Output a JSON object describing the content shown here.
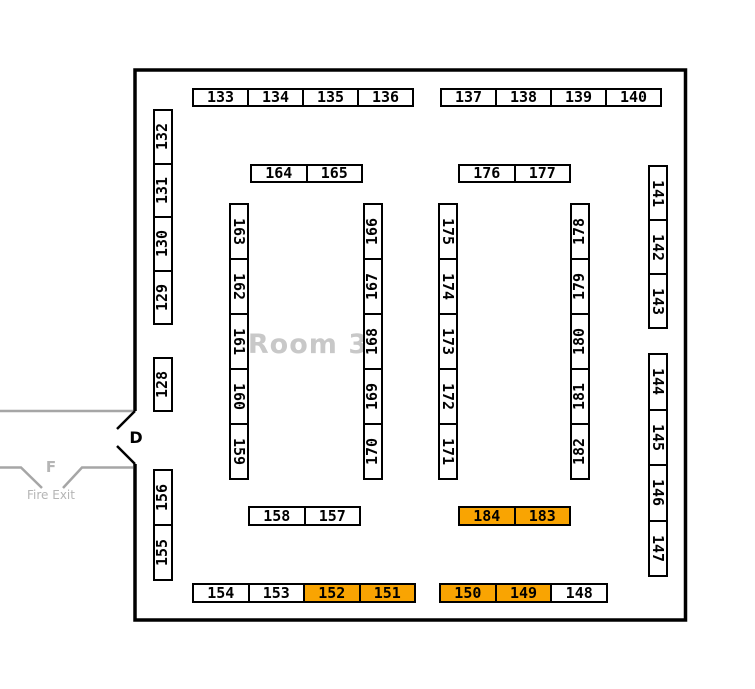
{
  "room": {
    "label": "Room 3"
  },
  "door": {
    "label": "D"
  },
  "fire_exit": {
    "label": "F",
    "text": "Fire Exit"
  },
  "colors": {
    "highlight": "#f9a402",
    "wall": "#000000",
    "corridor_gray": "#a6a6a6",
    "room_label_gray": "#c8c8c8",
    "gray_text": "#b5b5b5",
    "booth_fill": "#ffffff",
    "booth_border": "#000000"
  },
  "highlighted_booths": [
    "184",
    "183",
    "152",
    "151",
    "150",
    "149"
  ],
  "strips": [
    {
      "name": "top-row-west",
      "x": 192,
      "y": 88,
      "dir": "h",
      "cell_w": 57,
      "cell_h": 19,
      "orient": "h",
      "cells": [
        {
          "id": "133"
        },
        {
          "id": "134"
        },
        {
          "id": "135"
        },
        {
          "id": "136"
        }
      ]
    },
    {
      "name": "top-row-east",
      "x": 440,
      "y": 88,
      "dir": "h",
      "cell_w": 57,
      "cell_h": 19,
      "orient": "h",
      "cells": [
        {
          "id": "137"
        },
        {
          "id": "138"
        },
        {
          "id": "139"
        },
        {
          "id": "140"
        }
      ]
    },
    {
      "name": "row2-west",
      "x": 250,
      "y": 164,
      "dir": "h",
      "cell_w": 57.5,
      "cell_h": 19,
      "orient": "h",
      "cells": [
        {
          "id": "164"
        },
        {
          "id": "165"
        }
      ]
    },
    {
      "name": "row2-east",
      "x": 458,
      "y": 164,
      "dir": "h",
      "cell_w": 57.5,
      "cell_h": 19,
      "orient": "h",
      "cells": [
        {
          "id": "176"
        },
        {
          "id": "177"
        }
      ]
    },
    {
      "name": "left-wall-upper",
      "x": 153,
      "y": 109,
      "dir": "v",
      "cell_w": 20,
      "cell_h": 55.5,
      "orient": "ccw",
      "cells": [
        {
          "id": "132"
        },
        {
          "id": "131"
        },
        {
          "id": "130"
        },
        {
          "id": "129"
        }
      ]
    },
    {
      "name": "left-wall-mid",
      "x": 153,
      "y": 357,
      "dir": "v",
      "cell_w": 20,
      "cell_h": 55,
      "orient": "ccw",
      "cells": [
        {
          "id": "128"
        }
      ]
    },
    {
      "name": "left-wall-lower",
      "x": 153,
      "y": 469,
      "dir": "v",
      "cell_w": 20,
      "cell_h": 57,
      "orient": "ccw",
      "cells": [
        {
          "id": "156"
        },
        {
          "id": "155"
        }
      ]
    },
    {
      "name": "aisle1-west",
      "x": 229,
      "y": 203,
      "dir": "v",
      "cell_w": 20,
      "cell_h": 57,
      "orient": "cw",
      "cells": [
        {
          "id": "163"
        },
        {
          "id": "162"
        },
        {
          "id": "161"
        },
        {
          "id": "160"
        },
        {
          "id": "159"
        }
      ]
    },
    {
      "name": "aisle1-east",
      "x": 363,
      "y": 203,
      "dir": "v",
      "cell_w": 20,
      "cell_h": 57,
      "orient": "ccw",
      "cells": [
        {
          "id": "166"
        },
        {
          "id": "167"
        },
        {
          "id": "168"
        },
        {
          "id": "169"
        },
        {
          "id": "170"
        }
      ]
    },
    {
      "name": "aisle2-west",
      "x": 438,
      "y": 203,
      "dir": "v",
      "cell_w": 20,
      "cell_h": 57,
      "orient": "cw",
      "cells": [
        {
          "id": "175"
        },
        {
          "id": "174"
        },
        {
          "id": "173"
        },
        {
          "id": "172"
        },
        {
          "id": "171"
        }
      ]
    },
    {
      "name": "aisle2-east",
      "x": 570,
      "y": 203,
      "dir": "v",
      "cell_w": 20,
      "cell_h": 57,
      "orient": "ccw",
      "cells": [
        {
          "id": "178"
        },
        {
          "id": "179"
        },
        {
          "id": "180"
        },
        {
          "id": "181"
        },
        {
          "id": "182"
        }
      ]
    },
    {
      "name": "right-wall-upper",
      "x": 648,
      "y": 165,
      "dir": "v",
      "cell_w": 20,
      "cell_h": 56,
      "orient": "cw",
      "cells": [
        {
          "id": "141"
        },
        {
          "id": "142"
        },
        {
          "id": "143"
        }
      ]
    },
    {
      "name": "right-wall-lower",
      "x": 648,
      "y": 353,
      "dir": "v",
      "cell_w": 20,
      "cell_h": 57.5,
      "orient": "cw",
      "cells": [
        {
          "id": "144"
        },
        {
          "id": "145"
        },
        {
          "id": "146"
        },
        {
          "id": "147"
        }
      ]
    },
    {
      "name": "mid-bottom-west",
      "x": 248,
      "y": 506,
      "dir": "h",
      "cell_w": 57.5,
      "cell_h": 20,
      "orient": "h",
      "cells": [
        {
          "id": "158"
        },
        {
          "id": "157"
        }
      ]
    },
    {
      "name": "mid-bottom-east",
      "x": 458,
      "y": 506,
      "dir": "h",
      "cell_w": 57.5,
      "cell_h": 20,
      "orient": "h",
      "cells": [
        {
          "id": "184",
          "hl": true
        },
        {
          "id": "183",
          "hl": true
        }
      ]
    },
    {
      "name": "bottom-row-west",
      "x": 192,
      "y": 583,
      "dir": "h",
      "cell_w": 57.5,
      "cell_h": 20,
      "orient": "h",
      "cells": [
        {
          "id": "154"
        },
        {
          "id": "153"
        },
        {
          "id": "152",
          "hl": true
        },
        {
          "id": "151",
          "hl": true
        }
      ]
    },
    {
      "name": "bottom-row-east",
      "x": 439,
      "y": 583,
      "dir": "h",
      "cell_w": 57.7,
      "cell_h": 20,
      "orient": "h",
      "cells": [
        {
          "id": "150",
          "hl": true
        },
        {
          "id": "149",
          "hl": true
        },
        {
          "id": "148"
        }
      ]
    }
  ]
}
